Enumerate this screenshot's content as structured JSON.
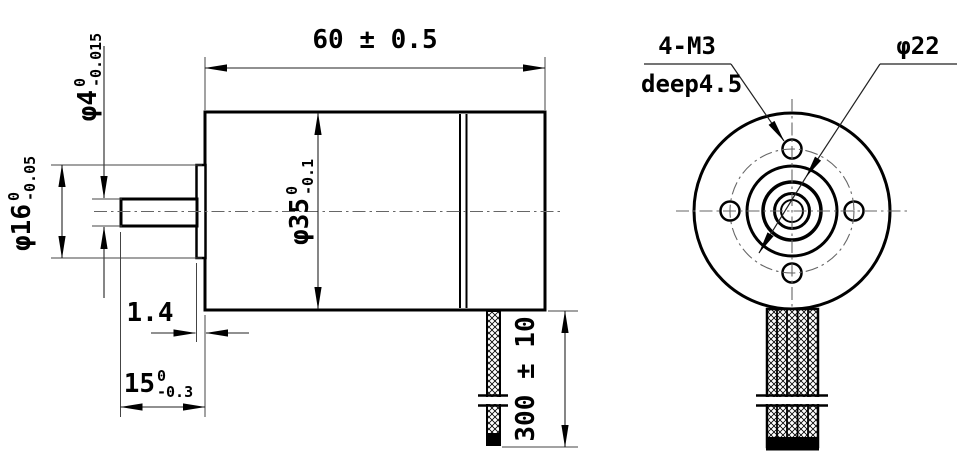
{
  "title": "motor-outline-drawing",
  "colors": {
    "ink": "#000000",
    "thin_line": "#555555",
    "background": "#ffffff"
  },
  "dims": {
    "body_length": "60 ± 0.5",
    "body_dia": {
      "base": "φ35",
      "sup": "0",
      "sub": "-0.1"
    },
    "shaft_dia": {
      "base": "φ4",
      "sup": "0",
      "sub": "-0.015"
    },
    "pilot_dia": {
      "base": "φ16",
      "sup": "0",
      "sub": "-0.05"
    },
    "pilot_protrusion": "1.4",
    "shaft_length": {
      "base": "15",
      "sup": "0",
      "sub": "-0.3"
    },
    "cable_length": "300 ± 10",
    "mount_holes": "4-M3",
    "mount_holes_depth": "deep4.5",
    "bolt_circle_dia": "φ22"
  }
}
